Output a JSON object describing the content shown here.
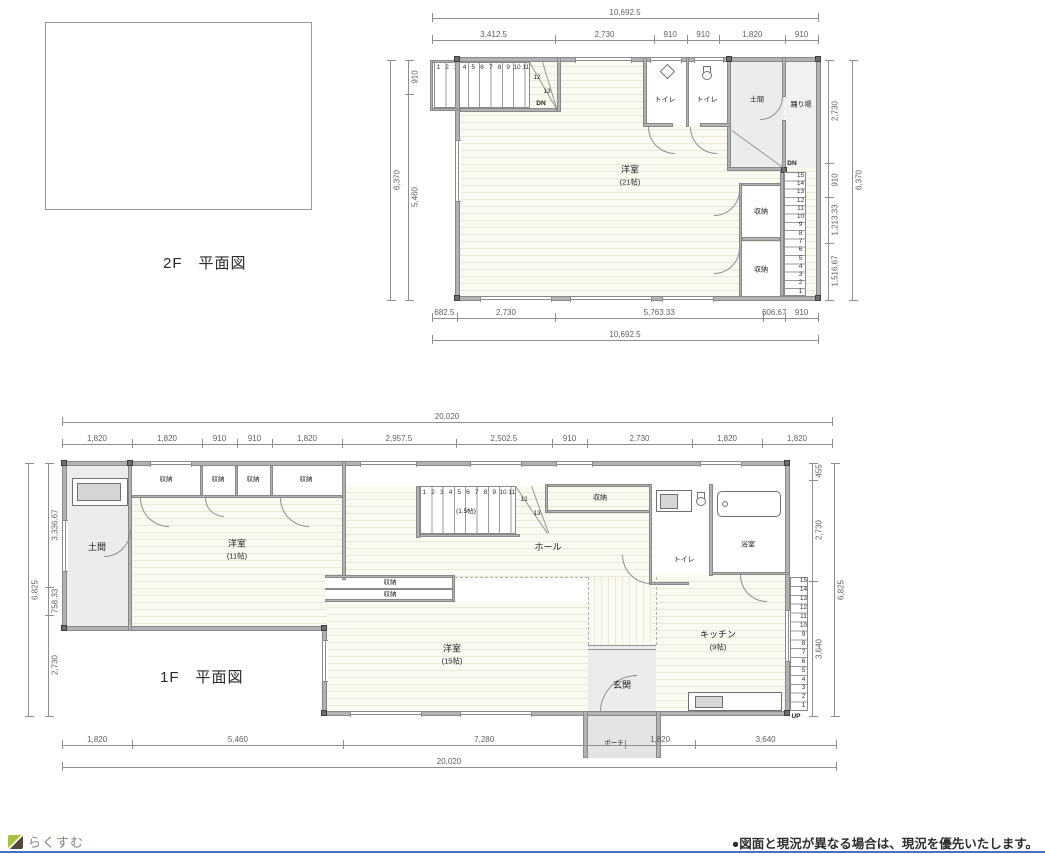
{
  "page": {
    "accent_line_color": "#4b6fc9"
  },
  "footer": {
    "logo_text": "らくすむ",
    "notice": "●図面と現況が異なる場合は、現況を優先いたします。"
  },
  "plan2f": {
    "title": "2F　平面図",
    "rooms": {
      "main": {
        "name": "洋室",
        "size": "(21帖)"
      },
      "toilet_left": "トイレ",
      "toilet_right": "トイレ",
      "doma": "土間",
      "landing": "踊り場",
      "closet_upper": "収納",
      "closet_lower": "収納"
    },
    "labels": {
      "dn_top": "DN",
      "dn_right": "DN",
      "winder_12": "12",
      "winder_13": "13"
    },
    "stair_top_numbers": [
      "1",
      "2",
      "3",
      "4",
      "5",
      "6",
      "7",
      "8",
      "9",
      "10",
      "11"
    ],
    "stair_right_numbers": [
      "15",
      "14",
      "13",
      "12",
      "11",
      "10",
      "9",
      "8",
      "7",
      "6",
      "5",
      "4",
      "3",
      "2",
      "1"
    ],
    "dims": {
      "top_total": "10,692.5",
      "top_segments": [
        "3,412.5",
        "2,730",
        "910",
        "910",
        "1,820",
        "910"
      ],
      "bottom_segments": [
        "682.5",
        "2,730",
        "5,763.33",
        "606.67",
        "910"
      ],
      "bottom_total": "10,692.5",
      "right_segments": [
        "2,730",
        "910",
        "1,213.33",
        "1,516.67"
      ],
      "right_total": "6,370",
      "left_segments": [
        "910",
        "5,460"
      ],
      "left_total": "6,370"
    }
  },
  "plan1f": {
    "title": "1F　平面図",
    "rooms": {
      "doma": "土間",
      "closets_top": [
        "収納",
        "収納",
        "収納",
        "収納"
      ],
      "bedroom_upper": {
        "name": "洋室",
        "size": "(11帖)"
      },
      "stair_size": "(1.5帖)",
      "hall_closet": "収納",
      "hall": "ホール",
      "toilet": "トイレ",
      "bath": "浴室",
      "kitchen": {
        "name": "キッチン",
        "size": "(9帖)"
      },
      "closet_mid_1": "収納",
      "closet_mid_2": "収納",
      "bedroom_lower": {
        "name": "洋室",
        "size": "(15帖)"
      },
      "entrance": "玄関",
      "porch": "ポーチ"
    },
    "labels": {
      "up": "UP",
      "winder_12": "12",
      "winder_13": "13"
    },
    "stair_numbers": [
      "1",
      "2",
      "3",
      "4",
      "5",
      "6",
      "7",
      "8",
      "9",
      "10",
      "11"
    ],
    "stair_right_numbers": [
      "15",
      "14",
      "13",
      "12",
      "11",
      "10",
      "9",
      "8",
      "7",
      "6",
      "5",
      "4",
      "3",
      "2",
      "1"
    ],
    "dims": {
      "top_total": "20,020",
      "top_segments": [
        "1,820",
        "1,820",
        "910",
        "910",
        "1,820",
        "2,957.5",
        "2,502.5",
        "910",
        "2,730",
        "1,820",
        "1,820"
      ],
      "bottom_segments": [
        "1,820",
        "5,460",
        "7,280",
        "1,820",
        "3,640"
      ],
      "bottom_total": "20,020",
      "left_segments": [
        "3,336.67",
        "758.33",
        "2,730"
      ],
      "left_total": "6,825",
      "right_segments": [
        "455",
        "2,730",
        "3,640"
      ],
      "right_total": "6,825"
    }
  }
}
